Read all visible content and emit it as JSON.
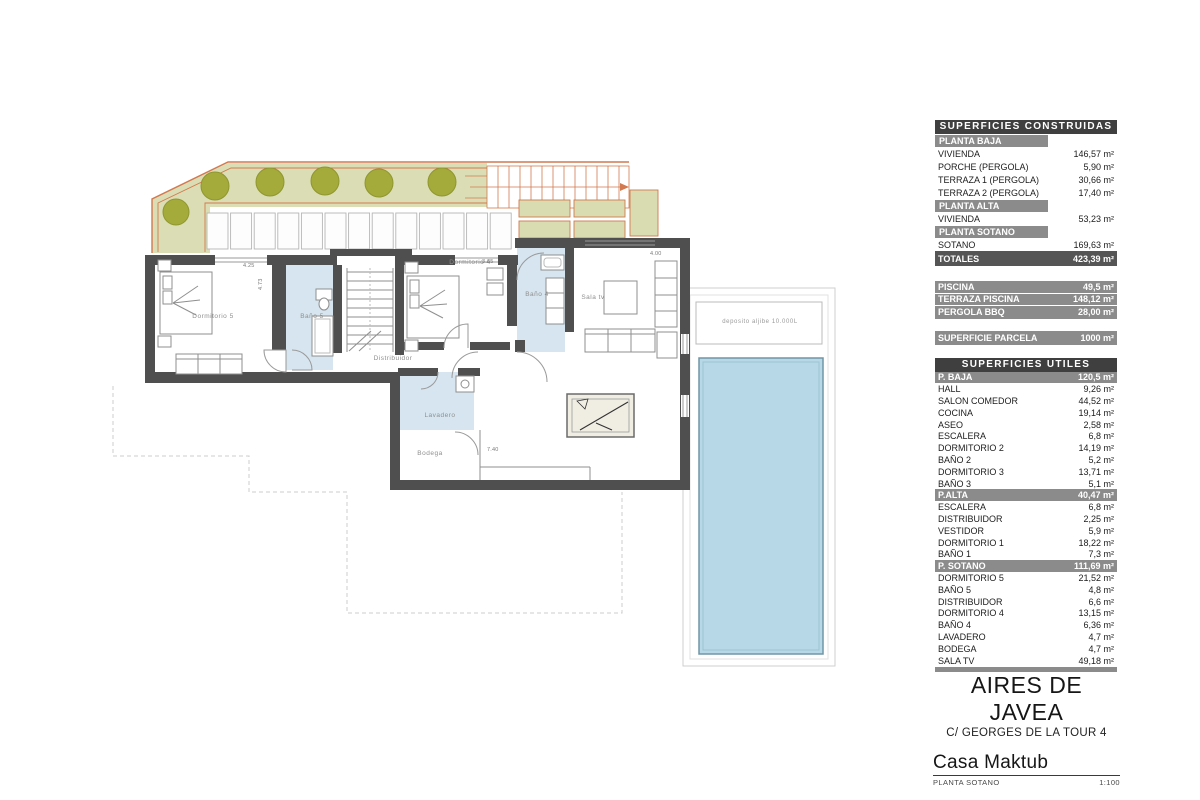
{
  "plan": {
    "labels": {
      "dormitorio5": "Dormitorio 5",
      "bano5": "Baño 5",
      "dormitorio4": "Dormitorio 4",
      "bano4": "Baño 4",
      "sala_tv": "Sala tv",
      "distribuidor": "Distribuidor",
      "lavadero": "Lavadero",
      "bodega": "Bodega",
      "deposito": "deposito aljibe 10.000L"
    },
    "dims": {
      "d1": "4.25",
      "d1v": "4.73",
      "d2": "3.65",
      "d3": "4.00",
      "d4": "7.40"
    }
  },
  "tables": {
    "construidas": {
      "title": "SUPERFICIES CONSTRUIDAS",
      "rows": [
        {
          "type": "section",
          "label": "PLANTA BAJA",
          "value": ""
        },
        {
          "type": "item",
          "label": "VIVIENDA",
          "value": "146,57 m²"
        },
        {
          "type": "item",
          "label": "PORCHE (PERGOLA)",
          "value": "5,90 m²"
        },
        {
          "type": "item",
          "label": "TERRAZA 1 (PERGOLA)",
          "value": "30,66 m²"
        },
        {
          "type": "item",
          "label": "TERRAZA 2 (PERGOLA)",
          "value": "17,40 m²"
        },
        {
          "type": "section",
          "label": "PLANTA ALTA",
          "value": ""
        },
        {
          "type": "item",
          "label": "VIVIENDA",
          "value": "53,23 m²"
        },
        {
          "type": "section",
          "label": "PLANTA SOTANO",
          "value": ""
        },
        {
          "type": "item",
          "label": "SOTANO",
          "value": "169,63 m²"
        },
        {
          "type": "total",
          "label": "TOTALES",
          "value": "423,39 m²"
        }
      ]
    },
    "piscina_block": {
      "rows": [
        {
          "label": "PISCINA",
          "value": "49,5 m²"
        },
        {
          "label": "TERRAZA PISCINA",
          "value": "148,12 m²"
        },
        {
          "label": "PERGOLA BBQ",
          "value": "28,00 m²"
        }
      ]
    },
    "parcela": {
      "label": "SUPERFICIE PARCELA",
      "value": "1000 m²"
    },
    "utiles": {
      "title": "SUPERFICIES UTILES",
      "rows": [
        {
          "type": "section",
          "label": "P. BAJA",
          "value": "120,5 m²"
        },
        {
          "type": "item",
          "label": "HALL",
          "value": "9,26 m²"
        },
        {
          "type": "item",
          "label": "SALON COMEDOR",
          "value": "44,52 m²"
        },
        {
          "type": "item",
          "label": "COCINA",
          "value": "19,14 m²"
        },
        {
          "type": "item",
          "label": "ASEO",
          "value": "2,58 m²"
        },
        {
          "type": "item",
          "label": "ESCALERA",
          "value": "6,8 m²"
        },
        {
          "type": "item",
          "label": "DORMITORIO 2",
          "value": "14,19 m²"
        },
        {
          "type": "item",
          "label": "BAÑO 2",
          "value": "5,2 m²"
        },
        {
          "type": "item",
          "label": "DORMITORIO 3",
          "value": "13,71 m²"
        },
        {
          "type": "item",
          "label": "BAÑO 3",
          "value": "5,1 m²"
        },
        {
          "type": "section",
          "label": "P.ALTA",
          "value": "40,47 m²"
        },
        {
          "type": "item",
          "label": "ESCALERA",
          "value": "6,8 m²"
        },
        {
          "type": "item",
          "label": "DISTRIBUIDOR",
          "value": "2,25 m²"
        },
        {
          "type": "item",
          "label": "VESTIDOR",
          "value": "5,9 m²"
        },
        {
          "type": "item",
          "label": "DORMITORIO 1",
          "value": "18,22 m²"
        },
        {
          "type": "item",
          "label": "BAÑO 1",
          "value": "7,3 m²"
        },
        {
          "type": "section",
          "label": "P. SOTANO",
          "value": "111,69 m²"
        },
        {
          "type": "item",
          "label": "DORMITORIO 5",
          "value": "21,52 m²"
        },
        {
          "type": "item",
          "label": "BAÑO 5",
          "value": "4,8 m²"
        },
        {
          "type": "item",
          "label": "DISTRIBUIDOR",
          "value": "6,6 m²"
        },
        {
          "type": "item",
          "label": "DORMITORIO 4",
          "value": "13,15 m²"
        },
        {
          "type": "item",
          "label": "BAÑO 4",
          "value": "6,36 m²"
        },
        {
          "type": "item",
          "label": "LAVADERO",
          "value": "4,7 m²"
        },
        {
          "type": "item",
          "label": "BODEGA",
          "value": "4,7 m²"
        },
        {
          "type": "item",
          "label": "SALA TV",
          "value": "49,18 m²"
        }
      ]
    }
  },
  "title_block": {
    "project": "AIRES DE JAVEA",
    "address": "C/ GEORGES DE LA TOUR 4",
    "name": "Casa Maktub",
    "sheet": "PLANTA SOTANO",
    "scale": "1:100"
  }
}
